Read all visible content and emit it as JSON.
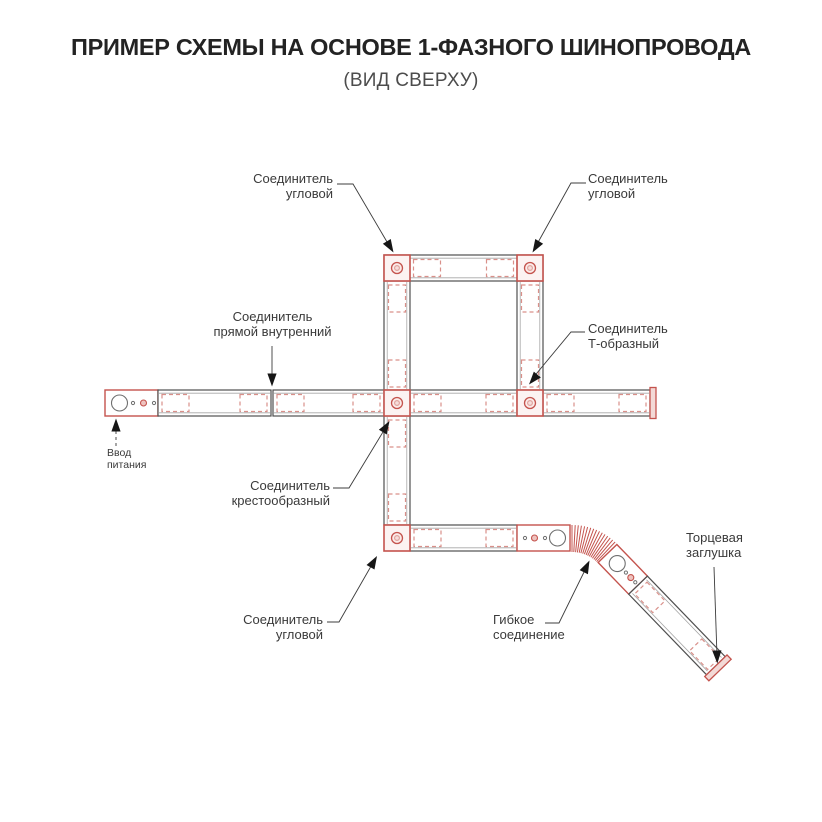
{
  "title": "ПРИМЕР СХЕМЫ НА ОСНОВЕ 1-ФАЗНОГО ШИНОПРОВОДА",
  "subtitle": "(ВИД СВЕРХУ)",
  "labels": {
    "corner_top_left": {
      "line1": "Соединитель",
      "line2": "угловой"
    },
    "corner_top_right": {
      "line1": "Соединитель",
      "line2": "угловой"
    },
    "straight_internal": {
      "line1": "Соединитель",
      "line2": "прямой внутренний"
    },
    "t_shaped": {
      "line1": "Соединитель",
      "line2": "Т-образный"
    },
    "cross": {
      "line1": "Соединитель",
      "line2": "крестообразный"
    },
    "corner_bottom": {
      "line1": "Соединитель",
      "line2": "угловой"
    },
    "flexible": {
      "line1": "Гибкое",
      "line2": "соединение"
    },
    "end_cap": {
      "line1": "Торцевая",
      "line2": "заглушка"
    },
    "power_input": {
      "line1": "Ввод",
      "line2": "питания"
    }
  },
  "colors": {
    "red": "#c4534d",
    "red_light": "#d9908a",
    "pink_fill": "#fcf3f2",
    "line_dark": "#4f4f4f",
    "rail_gray": "#a6a6a6",
    "text": "#3a3a3a"
  }
}
